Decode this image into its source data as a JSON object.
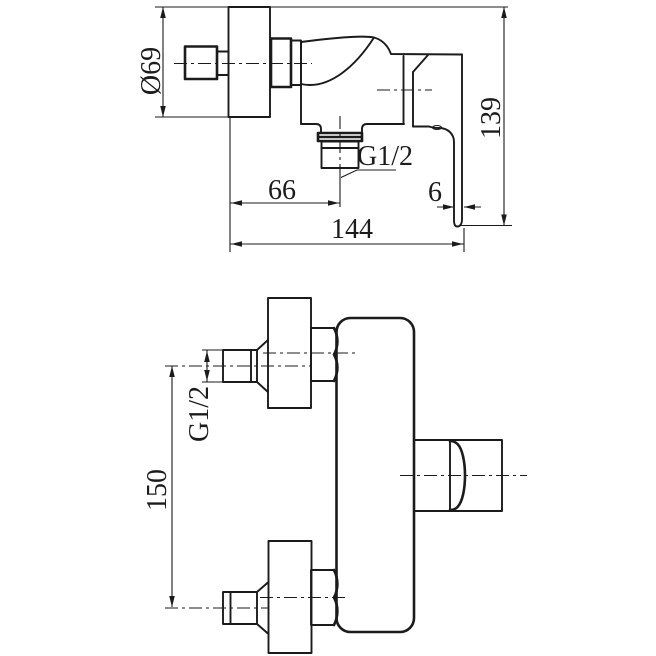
{
  "side_view": {
    "flange_diameter": "Ø69",
    "total_height": "139",
    "outlet_thread": "G1/2",
    "outlet_offset": "66",
    "handle_width": "6",
    "overall_depth": "144"
  },
  "front_view": {
    "inlet_thread": "G1/2",
    "inlet_spacing": "150"
  },
  "colors": {
    "line": "#1b1b1b",
    "background": "#ffffff"
  }
}
